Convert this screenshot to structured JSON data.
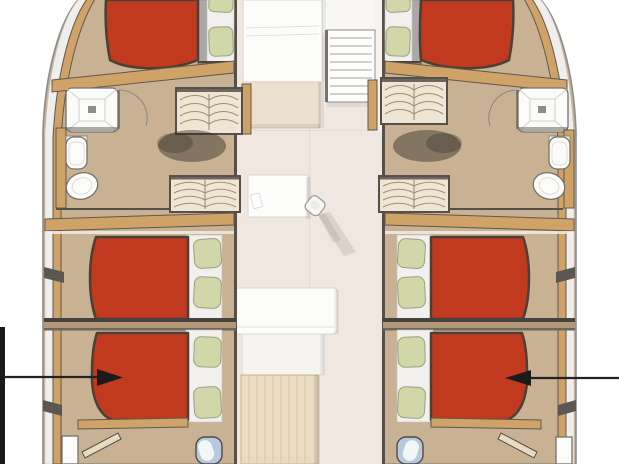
{
  "document": {
    "kind": "catamaran-interior-deck-plan",
    "visible_text": [],
    "hulls": [
      "port",
      "starboard"
    ],
    "rooms": {
      "port_forward_cabin": [
        "double-berth-red",
        "pillows",
        "shower",
        "toilet",
        "sink",
        "companionway-stairs"
      ],
      "port_mid_cabin": [
        "double-berth-red",
        "pillows"
      ],
      "port_aft_cabin": [
        "double-berth-red",
        "pillows",
        "door",
        "washbasin"
      ],
      "starboard_forward_cabin": [
        "double-berth-red",
        "pillows",
        "shower",
        "toilet",
        "sink",
        "companionway-stairs"
      ],
      "starboard_mid_cabin": [
        "double-berth-red",
        "pillows"
      ],
      "starboard_aft_cabin": [
        "double-berth-red",
        "pillows",
        "door",
        "washbasin"
      ],
      "saloon": [
        "galley-counter",
        "entry-steps",
        "nav-module",
        "small-sink",
        "table",
        "bench",
        "wood-panel"
      ]
    },
    "annotations": [
      {
        "id": "left-callout",
        "shape": "right-pointing-arrow",
        "points_at": "port-aft-berth"
      },
      {
        "id": "right-callout",
        "shape": "left-pointing-arrow",
        "points_at": "starboard-aft-berth"
      }
    ]
  },
  "colors": {
    "background": "#ffffff",
    "hull_floor": "#c9b294",
    "center_floor": "#f0e7e1",
    "bed_red": "#c13a20",
    "pillow_green": "#d2d7a9",
    "wood_trim": "#cfa267",
    "stairs_cream": "#efe5d2",
    "wall_dark": "#55504a",
    "mattress_white": "#f1f0ee",
    "headboard_gray": "#aba9a7",
    "panel_wood_light": "#eadbc3",
    "sink_blue": "#b7c9da",
    "shadow": "#2f2a23",
    "annotation_black": "#1b1b1b"
  }
}
